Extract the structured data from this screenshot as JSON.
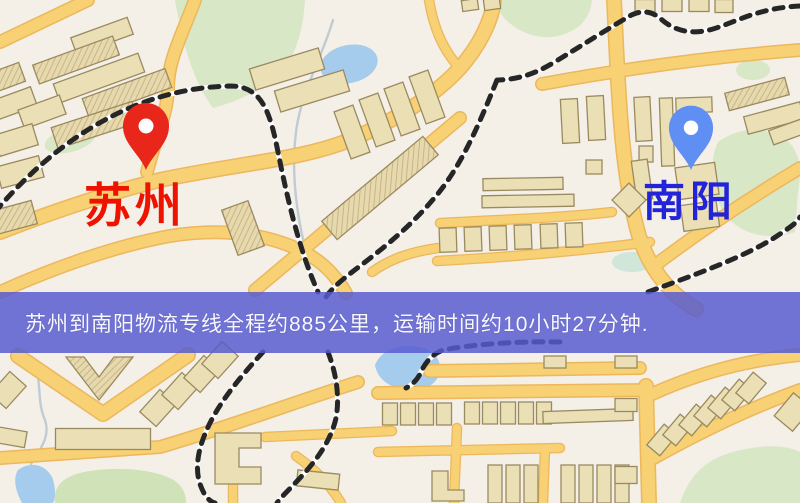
{
  "route_banner": {
    "text": "苏州到南阳物流专线全程约885公里，运输时间约10小时27分钟.",
    "background_color": "#575bd8",
    "text_color": "#f8f8fc"
  },
  "markers": {
    "origin": {
      "name": "苏州",
      "pin_color": "#e8261a",
      "label_color": "#ee1300"
    },
    "destination": {
      "name": "南阳",
      "pin_color": "#5f8ff2",
      "label_color": "#2323d8"
    }
  },
  "map": {
    "type": "street-map",
    "palette": {
      "background": "#f4efe7",
      "park_green": "#d8e7c6",
      "field_green": "#cfe2b8",
      "water_blue": "#a5cbed",
      "road_yellow": "#f7d173",
      "road_casing": "#ecb75d",
      "building_beige": "#ebdfb6",
      "building_outline": "#9a8a60",
      "railway_dark": "#262626"
    }
  }
}
